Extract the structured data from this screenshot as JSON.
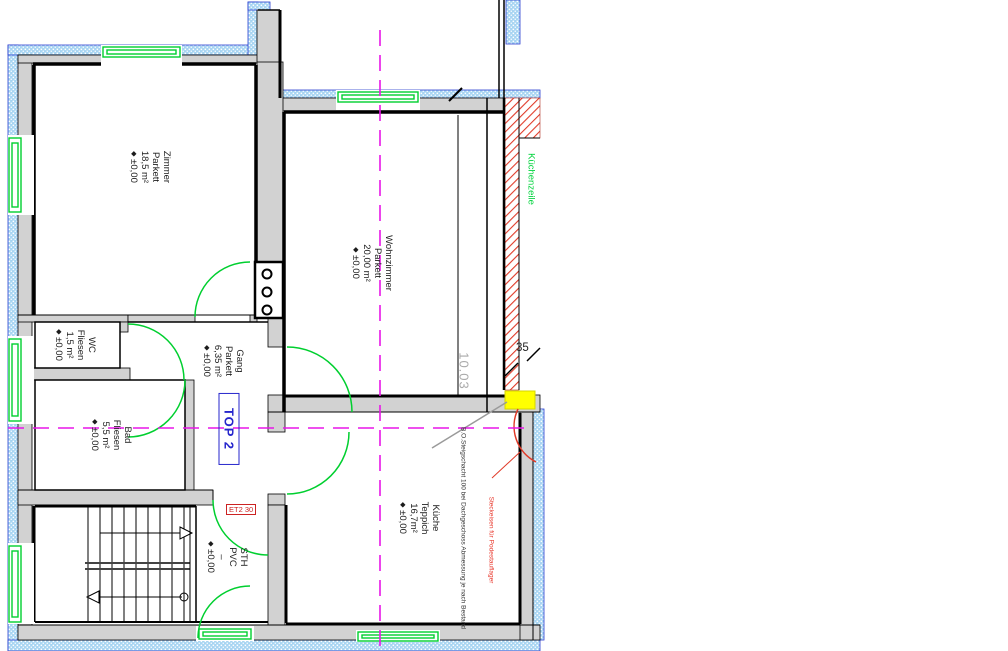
{
  "rooms": {
    "zimmer": {
      "name": "Zimmer",
      "floor": "Parkett",
      "area": "18,5 m²",
      "level": "±0,00"
    },
    "wohnzimmer": {
      "name": "Wohnzimmer",
      "floor": "Parkett",
      "area": "20,00 m²",
      "level": "±0,00"
    },
    "wc": {
      "name": "WC",
      "floor": "Fliesen",
      "area": "1,5 m²",
      "level": "±0,00"
    },
    "gang": {
      "name": "Gang",
      "floor": "Parkett",
      "area": "6,35 m²",
      "level": "±0,00"
    },
    "bad": {
      "name": "Bad",
      "floor": "Fliesen",
      "area": "5,5 m²",
      "level": "±0,00"
    },
    "kueche": {
      "name": "Küche",
      "floor": "Teppich",
      "area": "16,7m²",
      "level": "±0,00"
    },
    "sth": {
      "name": "STH",
      "floor": "PVC",
      "area": "–",
      "level": "±0,00"
    }
  },
  "icons": {
    "level_marker": "◆"
  },
  "annotations": {
    "unit_label": "TOP 2",
    "dim_height": "10.03",
    "dim_wall_thickness": "35",
    "kitchen_unit": "Küchenzeile",
    "note_red": "Steckeisen für Podestauflager",
    "note_shaft": "B.O.Steigschacht 100 bei Dachgeschoss Abmessung je nach Bestand",
    "door_tag": "ET2 30"
  },
  "colors": {
    "wall_fill": "#d2d2d2",
    "insulation_fill": "#a6d4f2",
    "insulation_edge": "#2b3fd0",
    "green": "#00cf2f",
    "magenta": "#e816e8",
    "red_hatch": "#e03a28",
    "yellow_marker": "#ffff00",
    "unit_label_blue": "#2626cc",
    "dim_gray": "#a9a9a9"
  }
}
